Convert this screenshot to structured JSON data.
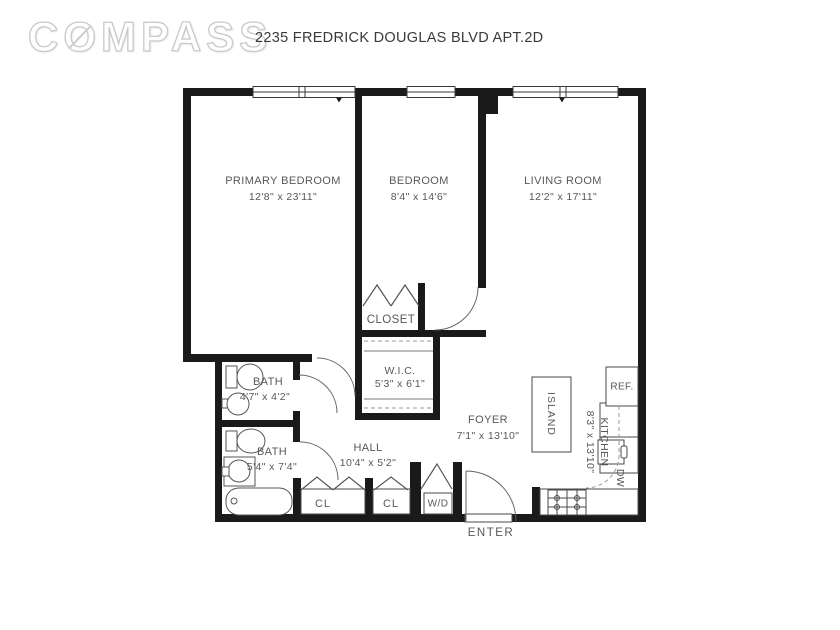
{
  "brand": {
    "logo_c": "C",
    "logo_o": "O",
    "logo_rest": "MPASS"
  },
  "title": "2235 FREDRICK DOUGLAS BLVD APT.2D",
  "rooms": {
    "primary_bedroom": {
      "name": "PRIMARY BEDROOM",
      "dims": "12'8\" x 23'11\""
    },
    "bedroom": {
      "name": "BEDROOM",
      "dims": "8'4\" x 14'6\""
    },
    "living_room": {
      "name": "LIVING ROOM",
      "dims": "12'2\" x 17'11\""
    },
    "closet": {
      "name": "CLOSET"
    },
    "wic": {
      "name": "W.I.C.",
      "dims": "5'3\" x 6'1\""
    },
    "bath_upper": {
      "name": "BATH",
      "dims": "4'7\" x 4'2\""
    },
    "bath_lower": {
      "name": "BATH",
      "dims": "5'4\" x 7'4\""
    },
    "hall": {
      "name": "HALL",
      "dims": "10'4\" x 5'2\""
    },
    "foyer": {
      "name": "FOYER",
      "dims": "7'1\" x 13'10\""
    },
    "kitchen": {
      "name": "KITCHEN",
      "dims": "8'3\" x 13'10\""
    },
    "island": {
      "name": "ISLAND"
    }
  },
  "fixtures": {
    "refrigerator": "REF.",
    "dishwasher": "DW",
    "washer_dryer": "W/D",
    "closet_1": "CL",
    "closet_2": "CL"
  },
  "entry": {
    "label": "ENTER"
  },
  "colors": {
    "wall": "#1a1a1a",
    "line": "#555555",
    "label": "#585858",
    "logo_outline": "#c9c9c9"
  }
}
